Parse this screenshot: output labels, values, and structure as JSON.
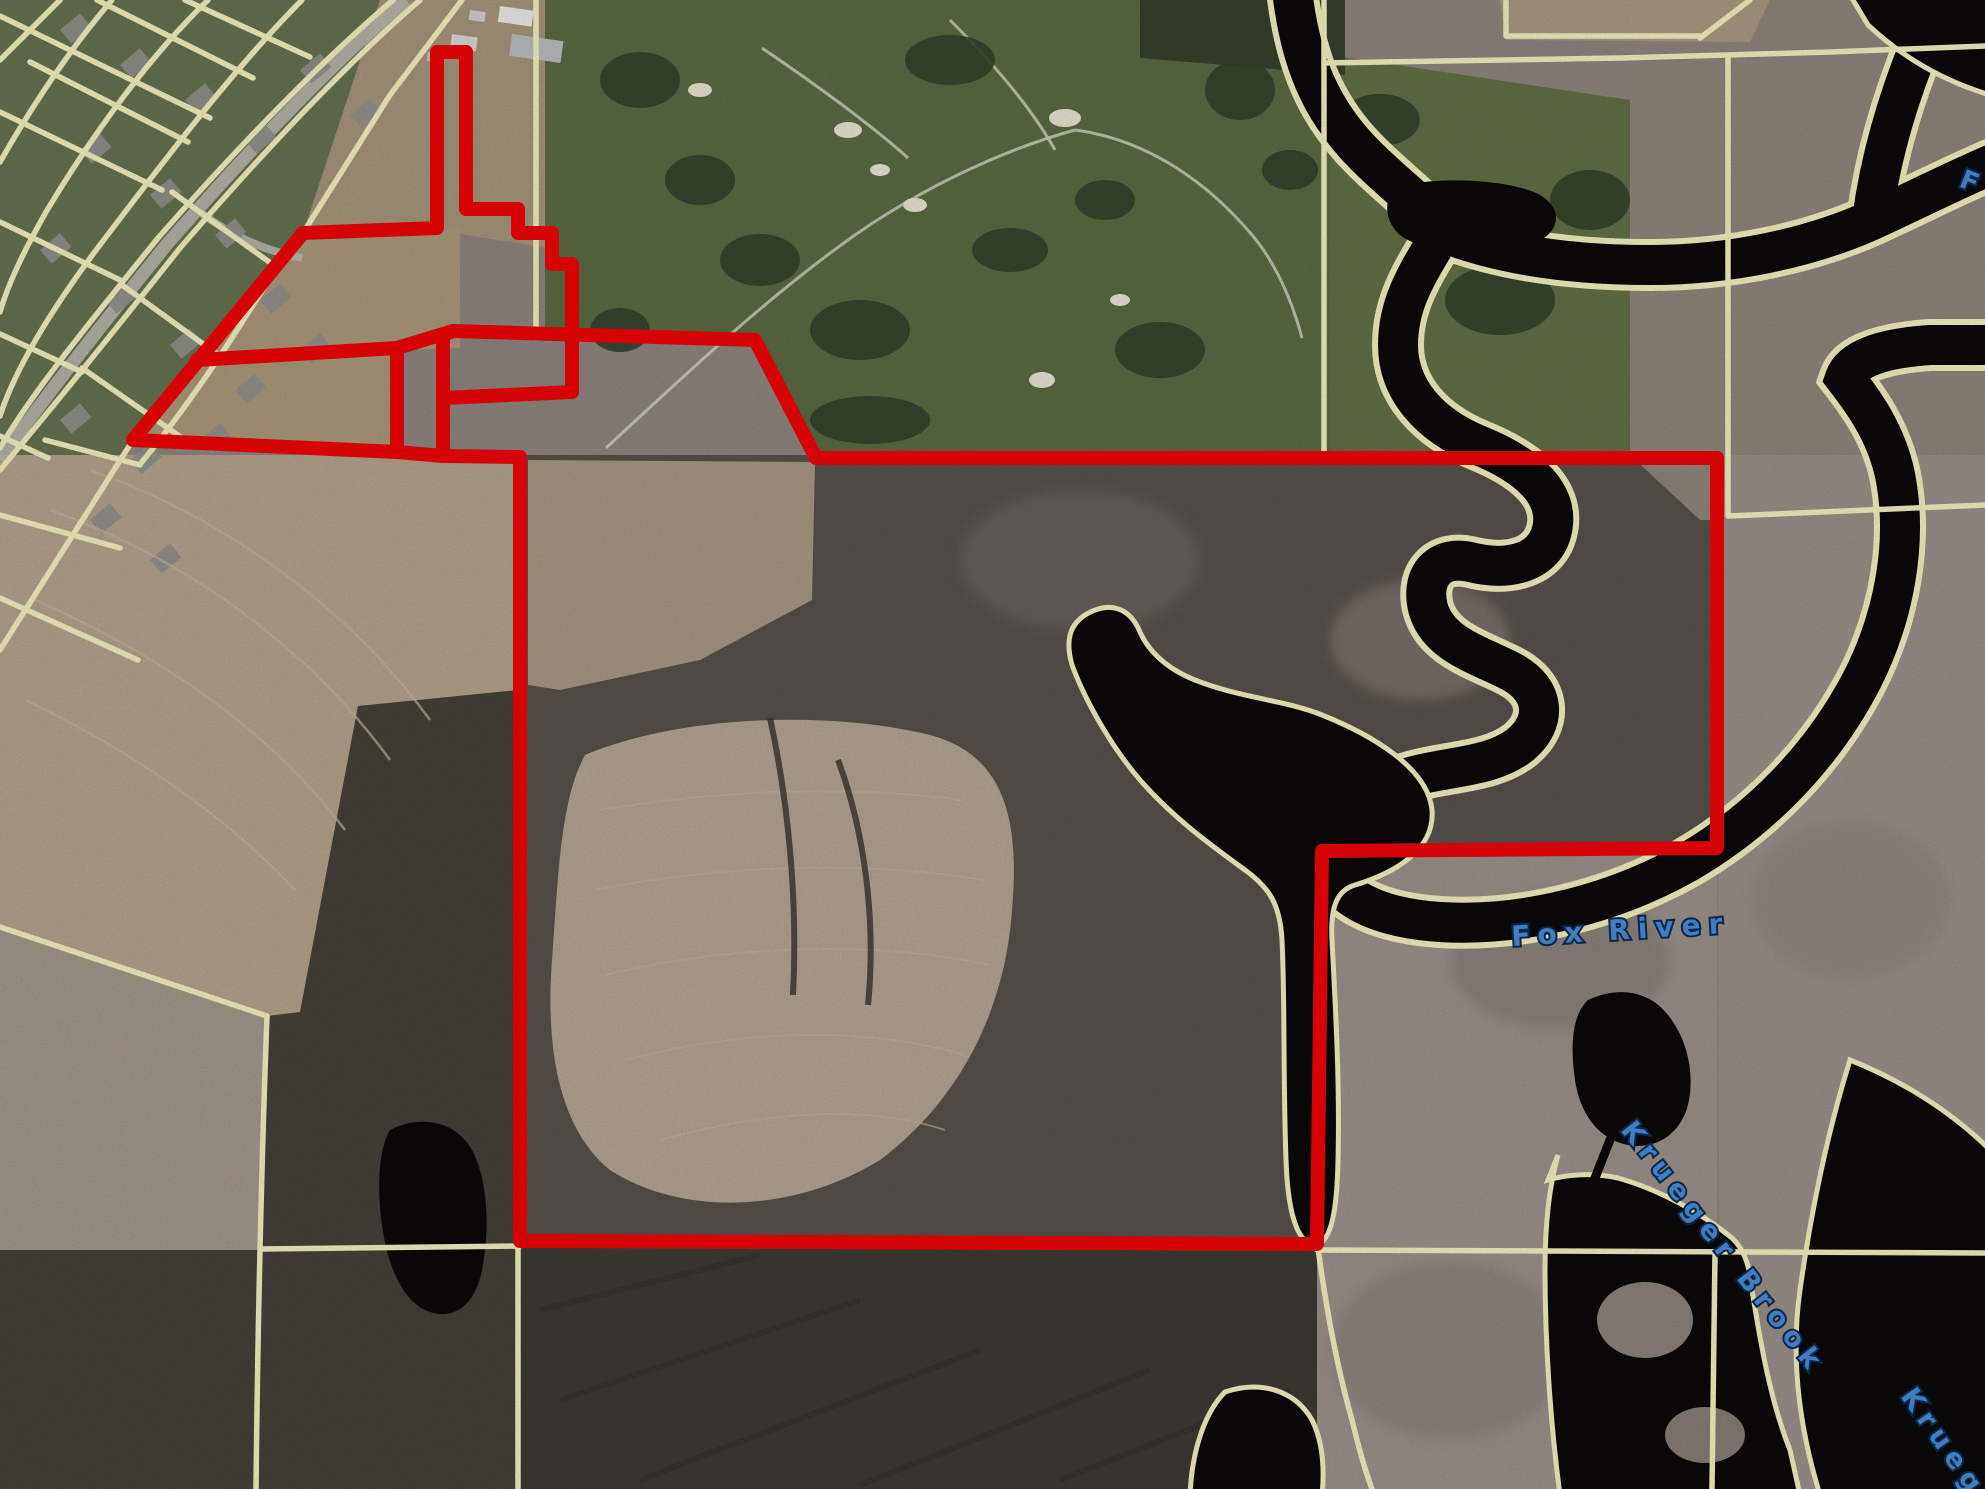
{
  "meta": {
    "title": "aerial-parcel-map",
    "width": 1985,
    "height": 1489
  },
  "colors": {
    "boundary_red": "#ec0408",
    "parcel_yellow": "#f1eebd",
    "water_dark": "#0b0809",
    "label_blue": "#4a8ad2",
    "label_outline": "#0d2b55",
    "marsh": "#8d847d",
    "road_gray": "#b9b7ae"
  },
  "labels": {
    "fox_river": {
      "text": "Fox River",
      "transform": "translate(1512,946) rotate(-3.5)",
      "fs": 28,
      "ls": 8
    },
    "krueger_brook": {
      "text": "Krueger Brook",
      "transform": "translate(1620,1130) rotate(52)",
      "fs": 27,
      "ls": 7
    },
    "krueger_partial": {
      "text": "Krueger",
      "transform": "translate(1900,1396) rotate(55)",
      "fs": 27,
      "ls": 7
    },
    "fox_partial": {
      "text": "F o",
      "transform": "translate(1958,186) rotate(22)",
      "fs": 26,
      "ls": 6
    }
  },
  "regions": [
    {
      "name": "region-parcel-forest",
      "d": "M520,455 L1720,455 L1720,850 L1322,850 L1317,1245 L520,1245 Z",
      "fill": "#57504b"
    },
    {
      "name": "region-subdivision",
      "d": "M0,0 L462,0 L303,233 L133,440 L0,652 Z",
      "fill": "#65714f"
    },
    {
      "name": "region-farm-field-top",
      "d": "M380,0 L560,0 L560,250 L437,230 L303,233 Z",
      "fill": "#a5947a"
    },
    {
      "name": "region-golf-course",
      "d": "M545,0 L1330,0 L1330,455 L818,458 L756,340 L545,336 Z",
      "fill": "#5a6a41"
    },
    {
      "name": "region-golf-east",
      "d": "M1330,55 L1630,100 L1630,455 L1330,455 Z",
      "fill": "#616f44"
    },
    {
      "name": "region-ne-marsh",
      "d": "M1630,0 L1985,0 L1985,520 L1700,520 L1630,455 Z",
      "fill": "#8e857b"
    },
    {
      "name": "region-ne-field-corner",
      "d": "M1500,0 L1770,0 L1750,42 L1506,40 Z",
      "fill": "#a79a80"
    },
    {
      "name": "region-golf-top-forest",
      "d": "M1140,0 L1345,0 L1345,75 L1140,58 Z",
      "fill": "#36402c"
    },
    {
      "name": "region-trapezoid-field",
      "d": "M303,233 L460,228 L460,348 L397,350 L397,452 L133,440 Z",
      "fill": "#a99878"
    },
    {
      "name": "region-west-field",
      "d": "M0,455 L518,455 L518,690 L358,706 L300,1012 L267,1016 L0,927 Z",
      "fill": "#b2a28a"
    },
    {
      "name": "region-west-gray-field",
      "d": "M0,927 L267,1016 L260,1250 L0,1250 Z",
      "fill": "#a2988b"
    },
    {
      "name": "region-west-forest",
      "d": "M358,706 L518,690 L518,1489 L0,1489 L0,1250 L260,1250 L267,1016 L300,1012 Z",
      "fill": "#454039"
    },
    {
      "name": "region-right-marsh",
      "d": "M1717,455 L1985,455 L1985,1489 L1720,1489 Z",
      "fill": "#998f88"
    },
    {
      "name": "region-midright-marsh",
      "d": "M1317,855 L1717,855 L1717,1489 L1317,1489 Z",
      "fill": "#9a9189"
    },
    {
      "name": "region-bottom-forest",
      "d": "M520,1245 L1317,1245 L1317,1489 L520,1489 Z",
      "fill": "#3d3933"
    },
    {
      "name": "region-parcel-nw-field",
      "d": "M528,460 L815,462 L812,600 L700,660 L560,690 L528,685 Z",
      "fill": "#a59783"
    },
    {
      "name": "region-parcel-center-field",
      "d": "M585,755 C680,715 830,710 930,735 C1005,755 1020,820 1012,910 C1005,1010 960,1100 880,1160 C790,1215 680,1215 610,1170 C560,1130 545,1050 552,960 C558,880 560,800 585,755 Z",
      "fill": "#b0a494"
    }
  ],
  "marsh_patches": [
    {
      "name": "marsh-patch",
      "cx": 1420,
      "cy": 640,
      "rx": 90,
      "ry": 60,
      "fill": "#7e756e"
    },
    {
      "name": "marsh-patch",
      "cx": 1560,
      "cy": 960,
      "rx": 110,
      "ry": 70,
      "fill": "#877e77"
    },
    {
      "name": "marsh-patch",
      "cx": 1850,
      "cy": 900,
      "rx": 100,
      "ry": 80,
      "fill": "#8f867e"
    },
    {
      "name": "marsh-patch",
      "cx": 1450,
      "cy": 1350,
      "rx": 120,
      "ry": 90,
      "fill": "#8a827b"
    },
    {
      "name": "marsh-patch",
      "cx": 1080,
      "cy": 560,
      "rx": 120,
      "ry": 70,
      "fill": "#6b645e"
    }
  ],
  "water": {
    "river_stroke_outer": 52,
    "river_stroke_inner": 40,
    "bank_stroke": 5,
    "channels": [
      {
        "name": "water-fox-river-main",
        "d": "M1292,-10 C1300,60 1320,110 1365,155 C1400,190 1425,205 1442,232 C1420,270 1398,300 1398,345 C1398,390 1430,425 1478,445 C1530,466 1560,495 1552,530 C1545,562 1510,572 1470,562 C1440,555 1420,575 1428,608 C1438,645 1480,655 1512,672 C1545,690 1548,722 1520,745 C1488,770 1440,765 1395,782 C1355,797 1328,825 1330,862 C1333,898 1380,918 1440,922 C1520,927 1612,905 1688,862 C1760,820 1822,757 1862,680 C1895,615 1908,540 1895,475 C1886,432 1862,400 1845,378 C1852,358 1885,348 1930,345 L1995,345"
      },
      {
        "name": "water-fox-river-east-arm",
        "d": "M1442,232 C1500,255 1570,265 1650,265 C1730,265 1810,248 1872,220 C1920,198 1955,180 1995,163"
      },
      {
        "name": "water-fox-river-north-spur",
        "d": "M1872,220 C1880,160 1897,100 1922,40 C1930,15 1936,-5 1940,-15"
      }
    ],
    "blobs": [
      {
        "name": "water-topright-pool",
        "d": "M1850,-5 L1990,-5 L1990,95 C1940,80 1900,55 1868,25 Z",
        "stroke": true
      },
      {
        "name": "water-bay",
        "d": "M1085,615 C1110,600 1130,608 1140,632 C1148,650 1165,668 1195,680 C1240,698 1285,700 1322,715 C1372,735 1428,768 1432,810 C1435,848 1398,872 1355,885 C1338,890 1330,905 1332,940 C1335,1000 1340,1080 1338,1160 C1337,1215 1330,1240 1318,1244 C1300,1248 1288,1220 1286,1160 C1283,1080 1285,1000 1282,940 C1280,905 1270,888 1245,870 C1215,848 1175,820 1140,780 C1110,745 1085,700 1072,665 C1065,640 1070,625 1085,615 Z",
        "stroke": true
      },
      {
        "name": "water-krueger-upper-pond",
        "d": "M1588,1000 C1620,985 1650,992 1668,1015 C1688,1040 1695,1075 1688,1105 C1680,1135 1655,1150 1628,1145 C1600,1140 1580,1115 1575,1080 C1570,1045 1572,1015 1588,1000 Z",
        "stroke": false
      },
      {
        "name": "water-krueger-marsh",
        "d": "M1558,1155 L1548,1180 C1565,1175 1590,1172 1618,1178 C1660,1190 1700,1212 1732,1238 C1745,1250 1750,1268 1752,1290 C1760,1340 1770,1400 1790,1450 L1800,1495 L1560,1495 C1550,1420 1545,1340 1545,1270 C1545,1230 1548,1190 1558,1155 Z",
        "stroke": true
      },
      {
        "name": "water-bottom-pond",
        "d": "M1225,1392 C1260,1380 1295,1390 1312,1420 C1322,1440 1325,1465 1322,1495 L1190,1495 C1192,1450 1205,1412 1225,1392 Z",
        "stroke": true
      },
      {
        "name": "water-right-edge-marsh",
        "d": "M1850,1060 C1900,1080 1950,1110 1990,1150 L1990,1495 L1820,1495 C1800,1430 1790,1360 1800,1290 C1810,1220 1825,1140 1850,1060 Z",
        "stroke": true
      },
      {
        "name": "water-golf-pond",
        "d": "M1395,190 C1420,175 1510,178 1540,195 C1565,210 1560,235 1530,245 C1490,257 1420,252 1400,235 C1385,222 1383,200 1395,190 Z",
        "stroke": false
      },
      {
        "name": "water-west-pond",
        "d": "M390,1130 C420,1115 455,1120 472,1150 C488,1180 490,1230 482,1270 C475,1305 455,1320 430,1312 C405,1304 388,1270 382,1225 C377,1190 378,1150 390,1130 Z",
        "stroke": false
      }
    ],
    "tails": [
      {
        "name": "water-krueger-tail",
        "d": "M1610,1140 C1600,1165 1592,1185 1585,1205 C1578,1225 1572,1240 1568,1252",
        "w": 9
      }
    ],
    "islands": [
      {
        "name": "marsh-island",
        "cx": 1645,
        "cy": 1320,
        "rx": 48,
        "ry": 38,
        "fill": "#8a817a"
      },
      {
        "name": "marsh-island",
        "cx": 1705,
        "cy": 1435,
        "rx": 40,
        "ry": 28,
        "fill": "#857c75"
      }
    ]
  },
  "parcel_lines": {
    "width": 5.5,
    "road_lines": [
      {
        "name": "parcel-line-road-ne",
        "d": "M420,0 C345,65 258,158 180,248 C115,330 52,408 0,470"
      },
      {
        "name": "parcel-line-road-sw",
        "d": "M393,0 C320,62 235,150 158,238 C95,316 32,392 0,448"
      }
    ],
    "lines": [
      {
        "name": "parcel-line",
        "d": "M0,16 L210,118"
      },
      {
        "name": "parcel-line",
        "d": "M0,112 L162,190"
      },
      {
        "name": "parcel-line",
        "d": "M0,222 L120,280"
      },
      {
        "name": "parcel-line",
        "d": "M0,334 L82,372"
      },
      {
        "name": "parcel-line",
        "d": "M0,436 L48,458"
      },
      {
        "name": "parcel-line",
        "d": "M97,0 L253,78"
      },
      {
        "name": "parcel-line",
        "d": "M185,0 L310,57"
      },
      {
        "name": "parcel-line",
        "d": "M30,62 L188,142"
      },
      {
        "name": "parcel-line",
        "d": "M302,0 C240,62 172,150 106,237 C56,302 16,366 0,416"
      },
      {
        "name": "parcel-line",
        "d": "M208,0 C150,56 94,132 46,212 C28,244 10,278 0,312"
      },
      {
        "name": "parcel-line",
        "d": "M112,0 C76,42 40,92 0,162"
      },
      {
        "name": "parcel-line",
        "d": "M172,192 L272,264"
      },
      {
        "name": "parcel-line",
        "d": "M122,285 L228,362"
      },
      {
        "name": "parcel-line",
        "d": "M82,368 L182,438"
      },
      {
        "name": "parcel-line",
        "d": "M45,440 L140,465"
      },
      {
        "name": "parcel-line",
        "d": "M295,238 C250,310 205,385 142,462"
      },
      {
        "name": "parcel-line",
        "d": "M133,440 L0,650"
      },
      {
        "name": "parcel-line",
        "d": "M0,515 L120,548"
      },
      {
        "name": "parcel-line",
        "d": "M0,598 L138,660"
      },
      {
        "name": "parcel-line",
        "d": "M462,0 L390,95 L303,233"
      },
      {
        "name": "parcel-line-section",
        "d": "M536,0 L536,338"
      },
      {
        "name": "parcel-line-section",
        "d": "M1324,0 L1324,457"
      },
      {
        "name": "parcel-line-section",
        "d": "M1324,63 L1620,58 L1830,52 L1985,46"
      },
      {
        "name": "parcel-line",
        "d": "M1700,38 L1750,0"
      },
      {
        "name": "parcel-line",
        "d": "M1506,0 L1506,36 L1700,36"
      },
      {
        "name": "parcel-line-section",
        "d": "M1728,58 L1728,516"
      },
      {
        "name": "parcel-line-section",
        "d": "M1728,516 L1985,505"
      },
      {
        "name": "parcel-line-section",
        "d": "M1317,1250 L1985,1253"
      },
      {
        "name": "parcel-line",
        "d": "M262,1249 L520,1246"
      },
      {
        "name": "parcel-line-section",
        "d": "M518,1241 L518,1489"
      },
      {
        "name": "parcel-line",
        "d": "M0,927 L267,1016"
      },
      {
        "name": "parcel-line",
        "d": "M267,1016 C262,1150 258,1300 256,1489"
      },
      {
        "name": "parcel-line",
        "d": "M1715,1253 L1712,1489"
      },
      {
        "name": "parcel-line",
        "d": "M1318,1248 C1325,1300 1335,1360 1352,1420 C1358,1445 1365,1470 1372,1489"
      },
      {
        "name": "parcel-line",
        "d": "M0,60 L60,0"
      }
    ]
  },
  "boundary": {
    "width": 14,
    "paths": [
      {
        "name": "property-boundary-main",
        "d": "M453,331 L755,340 L816,458 L1717,458 L1717,848 L1322,851 L1317,1244 L520,1241 L520,457 L443,456 L443,335 Z"
      },
      {
        "name": "property-boundary-box",
        "d": "M443,398 L572,392 L572,334"
      },
      {
        "name": "property-boundary-spike",
        "d": "M572,392 L572,264 L552,264 L552,233 L518,233 L518,209 L466,209 L466,52 L437,52 L437,228 L303,233 L133,440 L397,452 L443,456"
      },
      {
        "name": "property-boundary-inner-a",
        "d": "M397,452 L397,348"
      },
      {
        "name": "property-boundary-inner-b",
        "d": "M197,360 L397,348 L453,331"
      }
    ]
  },
  "details": {
    "road_pavement": [
      {
        "name": "road-pavement",
        "d": "M406,0 C330,64 246,154 168,243 C104,322 42,400 0,460",
        "w": 13
      },
      {
        "name": "road-branch",
        "d": "M200,212 C230,235 262,250 302,258",
        "w": 8
      }
    ],
    "cart_paths": [
      {
        "name": "golf-cart-path",
        "d": "M606,448 C690,370 770,295 855,235 C915,193 995,152 1075,130"
      },
      {
        "name": "golf-cart-path",
        "d": "M762,48 C815,84 868,122 908,158"
      },
      {
        "name": "golf-cart-path",
        "d": "M1075,130 C1150,140 1210,185 1252,235 C1275,262 1292,300 1302,338"
      },
      {
        "name": "golf-cart-path",
        "d": "M950,20 C990,60 1030,105 1055,150"
      }
    ],
    "tree_blobs": [
      [
        640,
        80,
        40,
        28
      ],
      [
        700,
        180,
        35,
        25
      ],
      [
        760,
        260,
        40,
        26
      ],
      [
        860,
        330,
        50,
        30
      ],
      [
        950,
        60,
        45,
        25
      ],
      [
        1010,
        250,
        38,
        22
      ],
      [
        1105,
        200,
        30,
        20
      ],
      [
        1160,
        350,
        45,
        28
      ],
      [
        870,
        420,
        60,
        24
      ],
      [
        620,
        330,
        30,
        22
      ],
      [
        1240,
        90,
        35,
        30
      ],
      [
        1290,
        170,
        28,
        20
      ],
      [
        1380,
        120,
        40,
        26
      ],
      [
        1500,
        300,
        55,
        35
      ],
      [
        1590,
        200,
        40,
        30
      ]
    ],
    "bunkers": [
      [
        848,
        130,
        14,
        8
      ],
      [
        880,
        170,
        10,
        6
      ],
      [
        915,
        205,
        12,
        7
      ],
      [
        1065,
        118,
        16,
        9
      ],
      [
        1042,
        380,
        13,
        8
      ],
      [
        1120,
        300,
        10,
        6
      ],
      [
        700,
        90,
        12,
        7
      ]
    ],
    "houses": [
      [
        60,
        30
      ],
      [
        120,
        65
      ],
      [
        185,
        100
      ],
      [
        245,
        140
      ],
      [
        80,
        150
      ],
      [
        150,
        195
      ],
      [
        215,
        235
      ],
      [
        40,
        250
      ],
      [
        105,
        300
      ],
      [
        170,
        345
      ],
      [
        235,
        390
      ],
      [
        60,
        420
      ],
      [
        130,
        460
      ],
      [
        300,
        70
      ],
      [
        350,
        115
      ],
      [
        260,
        300
      ],
      [
        300,
        350
      ],
      [
        200,
        440
      ],
      [
        90,
        520
      ],
      [
        150,
        560
      ]
    ],
    "farm_buildings": [
      [
        500,
        6,
        34,
        16,
        "#e8e8e6"
      ],
      [
        512,
        34,
        52,
        22,
        "#b9bcbd"
      ],
      [
        452,
        34,
        26,
        14,
        "#d8d6d2"
      ],
      [
        470,
        10,
        16,
        10,
        "#cfcfcb"
      ],
      [
        428,
        52,
        14,
        9,
        "#c8c6c0"
      ]
    ],
    "plow_arcs": [
      {
        "d": "M50,510 C190,560 310,650 390,760"
      },
      {
        "d": "M35,600 C160,655 270,730 345,830"
      },
      {
        "d": "M25,700 C130,750 225,815 295,890"
      },
      {
        "d": "M90,470 C230,520 350,610 430,720"
      }
    ],
    "field_streaks": [
      {
        "d": "M600,810 C720,790 850,785 960,800"
      },
      {
        "d": "M595,890 C720,865 860,860 985,880"
      },
      {
        "d": "M605,975 C730,945 870,940 990,965"
      },
      {
        "d": "M625,1060 C740,1030 860,1025 965,1055"
      },
      {
        "d": "M660,1140 C770,1110 870,1105 945,1130"
      }
    ],
    "dark_streaks": [
      {
        "d": "M540,1310 L760,1255"
      },
      {
        "d": "M560,1400 L860,1300"
      },
      {
        "d": "M640,1480 L980,1350"
      },
      {
        "d": "M860,1485 L1150,1370"
      },
      {
        "d": "M1060,1480 L1290,1390"
      },
      {
        "d": "M770,718 C788,800 798,900 793,995"
      },
      {
        "d": "M838,760 C866,835 876,925 868,1005"
      }
    ]
  }
}
